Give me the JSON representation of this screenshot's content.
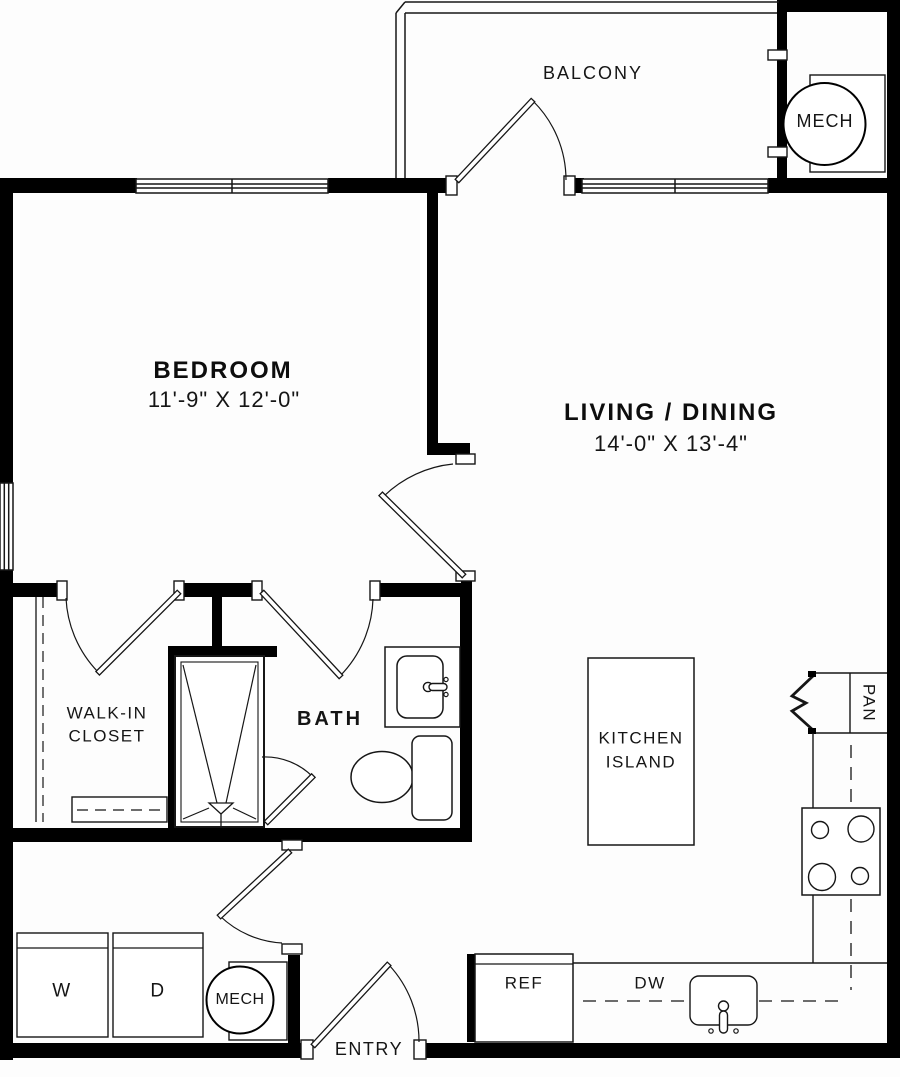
{
  "colors": {
    "ink": "#000000",
    "line": "#161616",
    "background": "#fdfdfd"
  },
  "rooms": {
    "balcony": {
      "label": "BALCONY"
    },
    "bedroom": {
      "label": "BEDROOM",
      "dims": "11'-9\" X 12'-0\""
    },
    "living_dining": {
      "label": "LIVING / DINING",
      "dims": "14'-0\" X 13'-4\""
    },
    "walk_in_closet": {
      "line1": "WALK-IN",
      "line2": "CLOSET"
    },
    "bath": {
      "label": "BATH"
    },
    "kitchen_island": {
      "line1": "KITCHEN",
      "line2": "ISLAND"
    },
    "entry": {
      "label": "ENTRY"
    }
  },
  "fixtures": {
    "mech_upper": {
      "label": "MECH"
    },
    "mech_lower": {
      "label": "MECH"
    },
    "pantry": {
      "label": "PAN"
    },
    "washer": {
      "label": "W"
    },
    "dryer": {
      "label": "D"
    },
    "refrigerator": {
      "label": "REF"
    },
    "dishwasher": {
      "label": "DW"
    }
  }
}
